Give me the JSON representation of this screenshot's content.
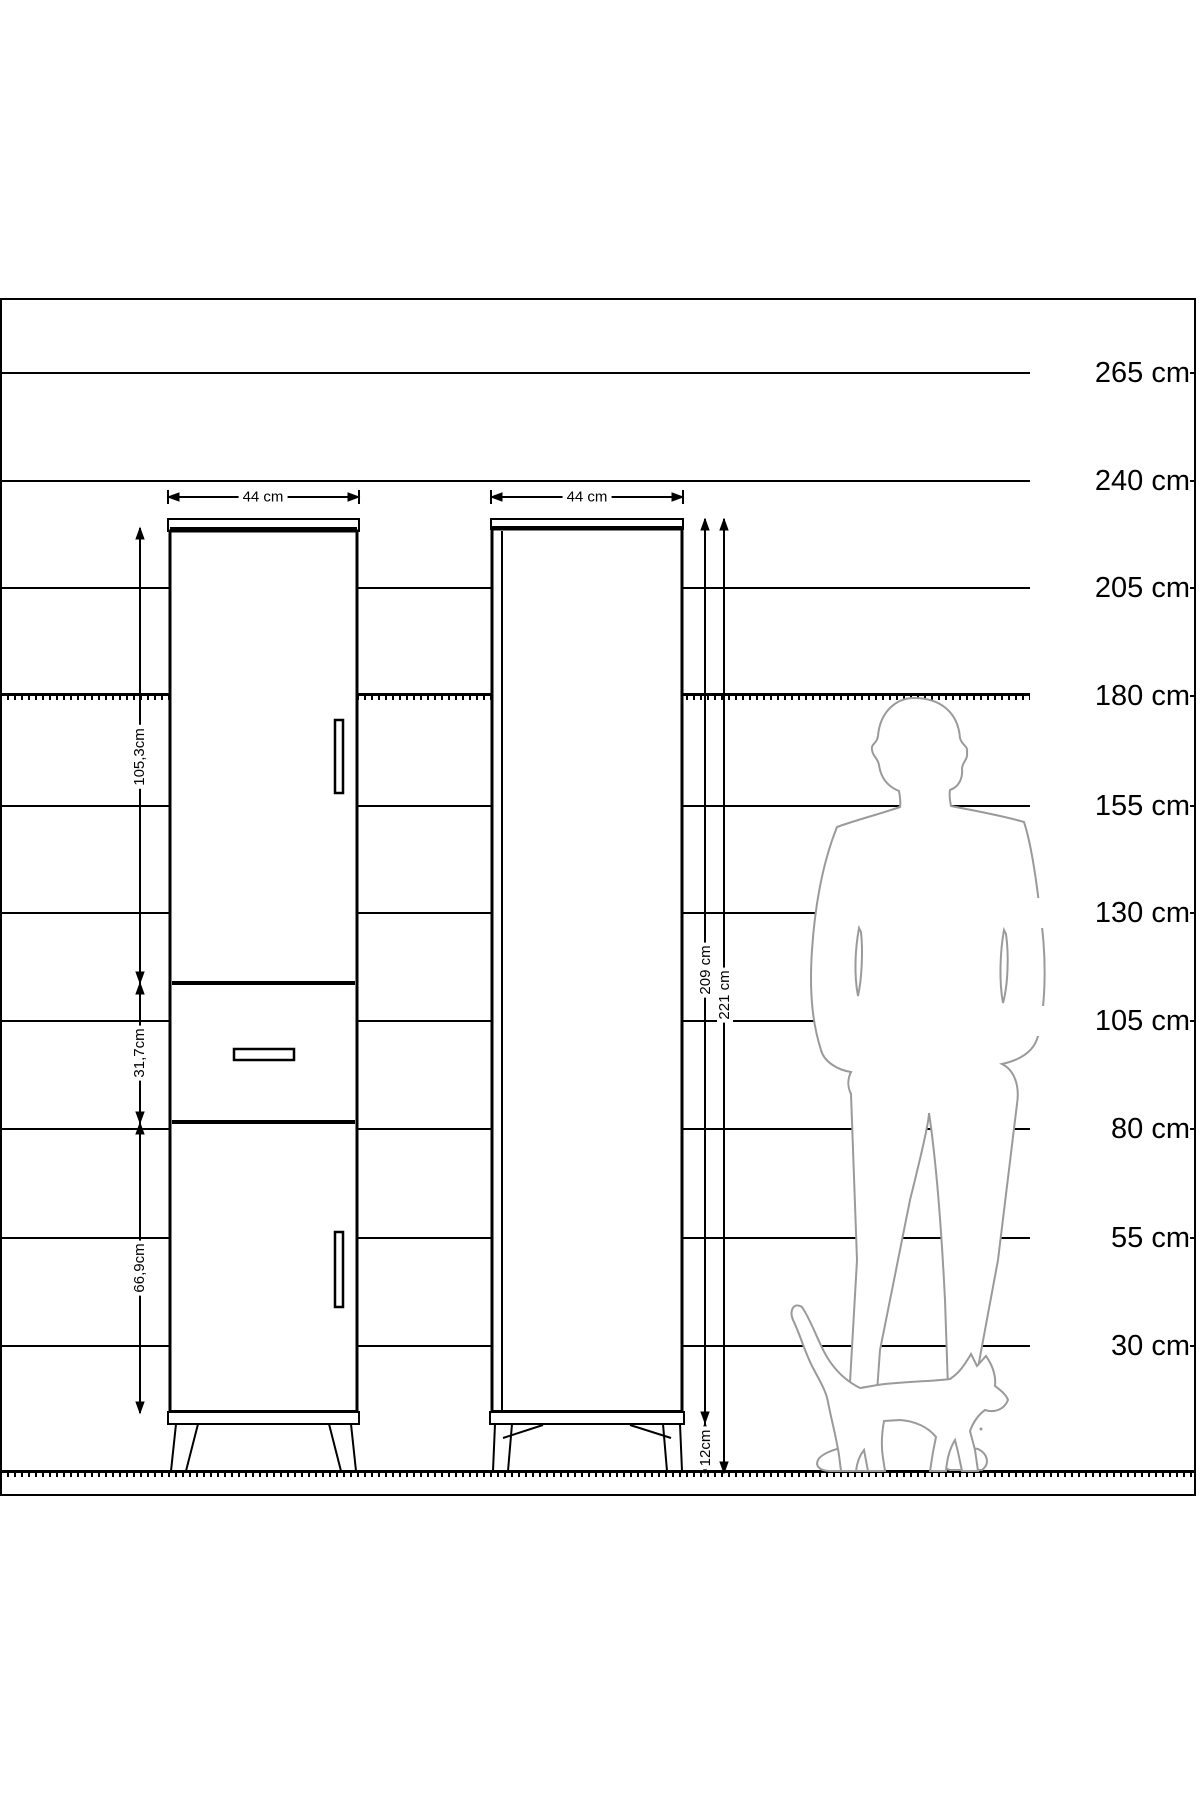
{
  "diagram": {
    "unit": "cm",
    "colors": {
      "line": "#000000",
      "silhouette": "#9a9a9a",
      "background": "#ffffff"
    },
    "scale_marks": [
      {
        "label": "265 cm",
        "cm": 265
      },
      {
        "label": "240 cm",
        "cm": 240
      },
      {
        "label": "205 cm",
        "cm": 205
      },
      {
        "label": "180 cm",
        "cm": 180,
        "style": "hatched"
      },
      {
        "label": "155 cm",
        "cm": 155
      },
      {
        "label": "130 cm",
        "cm": 130
      },
      {
        "label": "105 cm",
        "cm": 105
      },
      {
        "label": "80 cm",
        "cm": 80
      },
      {
        "label": "55 cm",
        "cm": 55
      },
      {
        "label": "30 cm",
        "cm": 30
      }
    ],
    "left_cabinet": {
      "view": "front",
      "width_label": "44 cm",
      "upper_door_height_label": "105,3cm",
      "drawer_height_label": "31,7cm",
      "lower_door_height_label": "66,9cm"
    },
    "right_cabinet": {
      "view": "side",
      "width_label": "44 cm",
      "body_height_label": "209 cm",
      "total_height_label": "221 cm",
      "leg_height_label": "12cm"
    },
    "figures": [
      "man-silhouette",
      "cat-silhouette"
    ]
  }
}
